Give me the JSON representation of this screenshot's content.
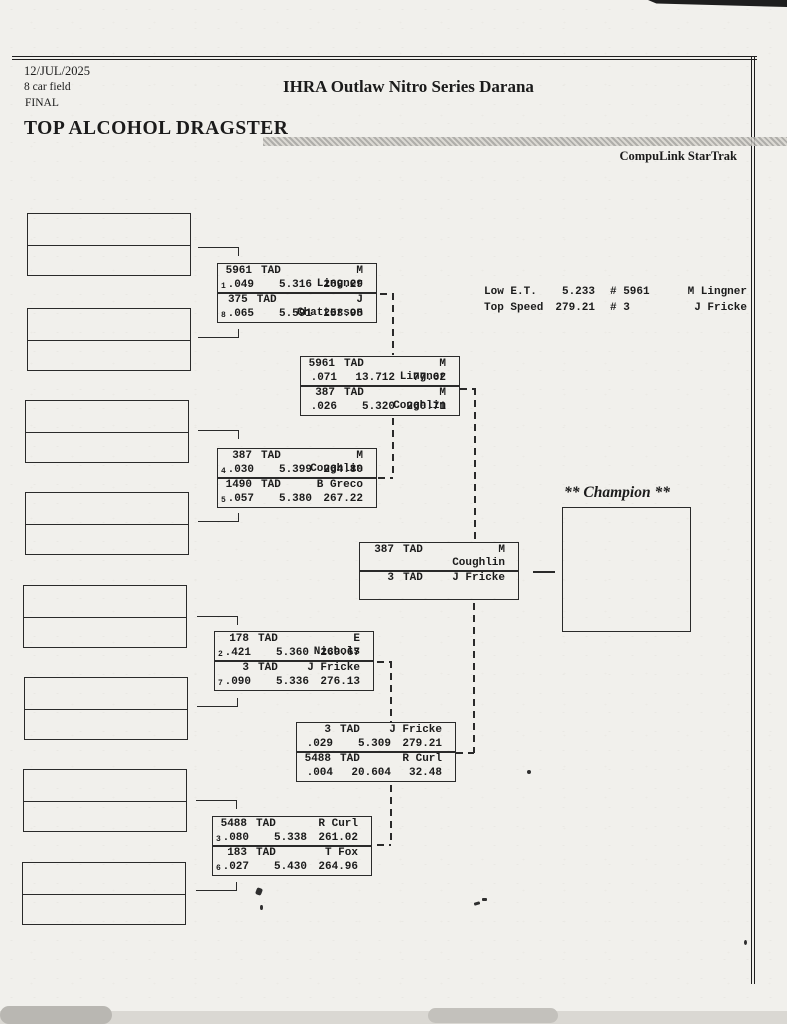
{
  "header": {
    "date": "12/JUL/2025",
    "field": "8 car field",
    "round": "FINAL",
    "title": "IHRA Outlaw Nitro Series Darana",
    "class_title": "TOP ALCOHOL DRAGSTER",
    "timing_brand": "CompuLink StarTrak"
  },
  "stats": {
    "low_et": {
      "label": "Low  E.T.",
      "value": "5.233",
      "car": "# 5961",
      "driver": "M Lingner"
    },
    "top_speed": {
      "label": "Top Speed",
      "value": "279.21",
      "car": "# 3",
      "driver": "J Fricke"
    }
  },
  "champion": {
    "label": "** Champion **"
  },
  "bracket": {
    "quarterfinals": [
      {
        "entries": [
          {
            "seed": "1",
            "number": "5961",
            "class": "TAD",
            "driver": "M Lingner",
            "reaction": ".049",
            "et": "5.316",
            "speed": "269.29"
          },
          {
            "seed": "8",
            "number": "375",
            "class": "TAD",
            "driver": "J Chatterson",
            "reaction": ".065",
            "et": "5.591",
            "speed": "253.95"
          }
        ]
      },
      {
        "entries": [
          {
            "seed": "4",
            "number": "387",
            "class": "TAD",
            "driver": "M Coughlin",
            "reaction": ".030",
            "et": "5.399",
            "speed": "264.80"
          },
          {
            "seed": "5",
            "number": "1490",
            "class": "TAD",
            "driver": "B Greco",
            "reaction": ".057",
            "et": "5.380",
            "speed": "267.22"
          }
        ]
      },
      {
        "entries": [
          {
            "seed": "2",
            "number": "178",
            "class": "TAD",
            "driver": "E Nichols",
            "reaction": ".421",
            "et": "5.360",
            "speed": "269.67"
          },
          {
            "seed": "7",
            "number": "3",
            "class": "TAD",
            "driver": "J Fricke",
            "reaction": ".090",
            "et": "5.336",
            "speed": "276.13"
          }
        ]
      },
      {
        "entries": [
          {
            "seed": "3",
            "number": "5488",
            "class": "TAD",
            "driver": "R Curl",
            "reaction": ".080",
            "et": "5.338",
            "speed": "261.02"
          },
          {
            "seed": "6",
            "number": "183",
            "class": "TAD",
            "driver": "T Fox",
            "reaction": ".027",
            "et": "5.430",
            "speed": "264.96"
          }
        ]
      }
    ],
    "semifinals": [
      {
        "entries": [
          {
            "number": "5961",
            "class": "TAD",
            "driver": "M Lingner",
            "reaction": ".071",
            "et": "13.712",
            "speed": "77.62"
          },
          {
            "number": "387",
            "class": "TAD",
            "driver": "M Coughlin",
            "reaction": ".026",
            "et": "5.320",
            "speed": "260.71"
          }
        ]
      },
      {
        "entries": [
          {
            "number": "3",
            "class": "TAD",
            "driver": "J Fricke",
            "reaction": ".029",
            "et": "5.309",
            "speed": "279.21"
          },
          {
            "number": "5488",
            "class": "TAD",
            "driver": "R Curl",
            "reaction": ".004",
            "et": "20.604",
            "speed": "32.48"
          }
        ]
      }
    ],
    "final": {
      "entries": [
        {
          "number": "387",
          "class": "TAD",
          "driver": "M Coughlin"
        },
        {
          "number": "3",
          "class": "TAD",
          "driver": "J Fricke"
        }
      ]
    }
  }
}
